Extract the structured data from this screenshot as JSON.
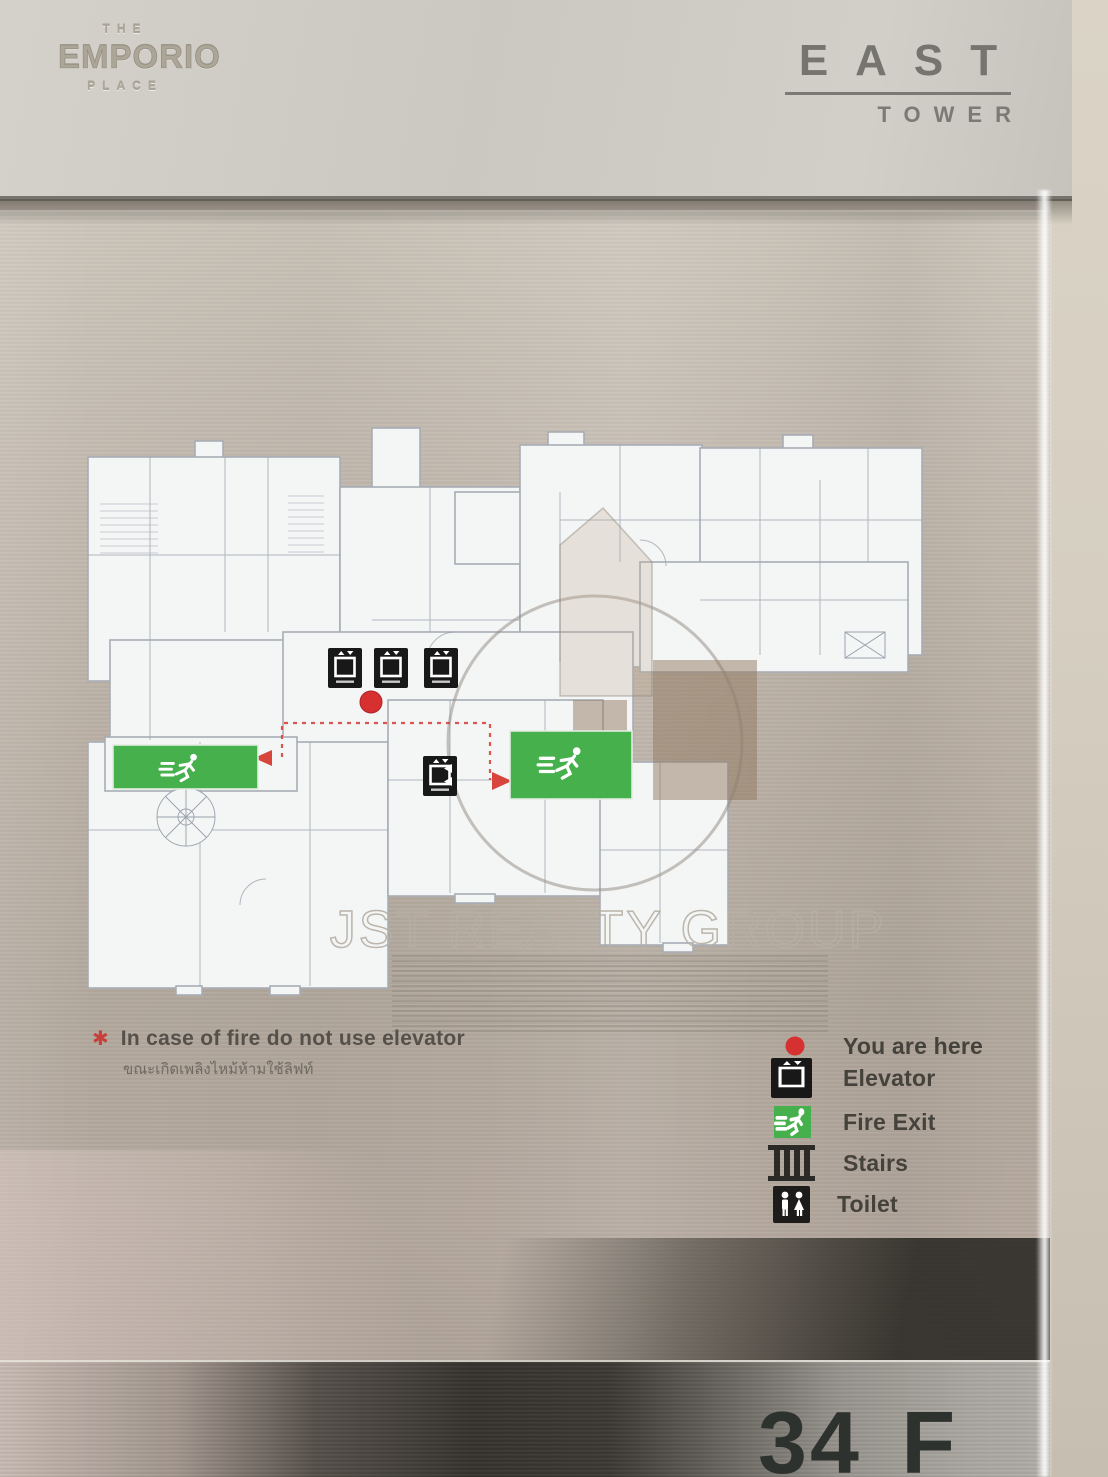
{
  "header": {
    "brand_line1": "THE",
    "brand_name": "EMPORIO",
    "brand_line3": "PLACE",
    "tower_name": "EAST",
    "tower_sub": "TOWER"
  },
  "watermark": {
    "text": "JST REALTY GROUP"
  },
  "fire_notice": {
    "icon": "star-asterisk-icon",
    "text_en": "In case of fire do not use elevator",
    "text_th": "ขณะเกิดเพลิงไหม้ห้ามใช้ลิฟท์"
  },
  "legend": {
    "items": [
      {
        "icon": "you-are-here-dot",
        "label": "You are here"
      },
      {
        "icon": "elevator-icon",
        "label": "Elevator"
      },
      {
        "icon": "fire-exit-icon",
        "label": "Fire Exit"
      },
      {
        "icon": "stairs-icon",
        "label": "Stairs"
      },
      {
        "icon": "toilet-icon",
        "label": "Toilet"
      }
    ]
  },
  "floor_label": "34 F",
  "colors": {
    "you_are_here": "#d63031",
    "fire_exit_green": "#46b14c",
    "elevator_black": "#1a1a1a",
    "escape_route_red": "#d8453c",
    "panel_metal": "#b9afa4",
    "wall_beige": "#d6cfc2"
  }
}
